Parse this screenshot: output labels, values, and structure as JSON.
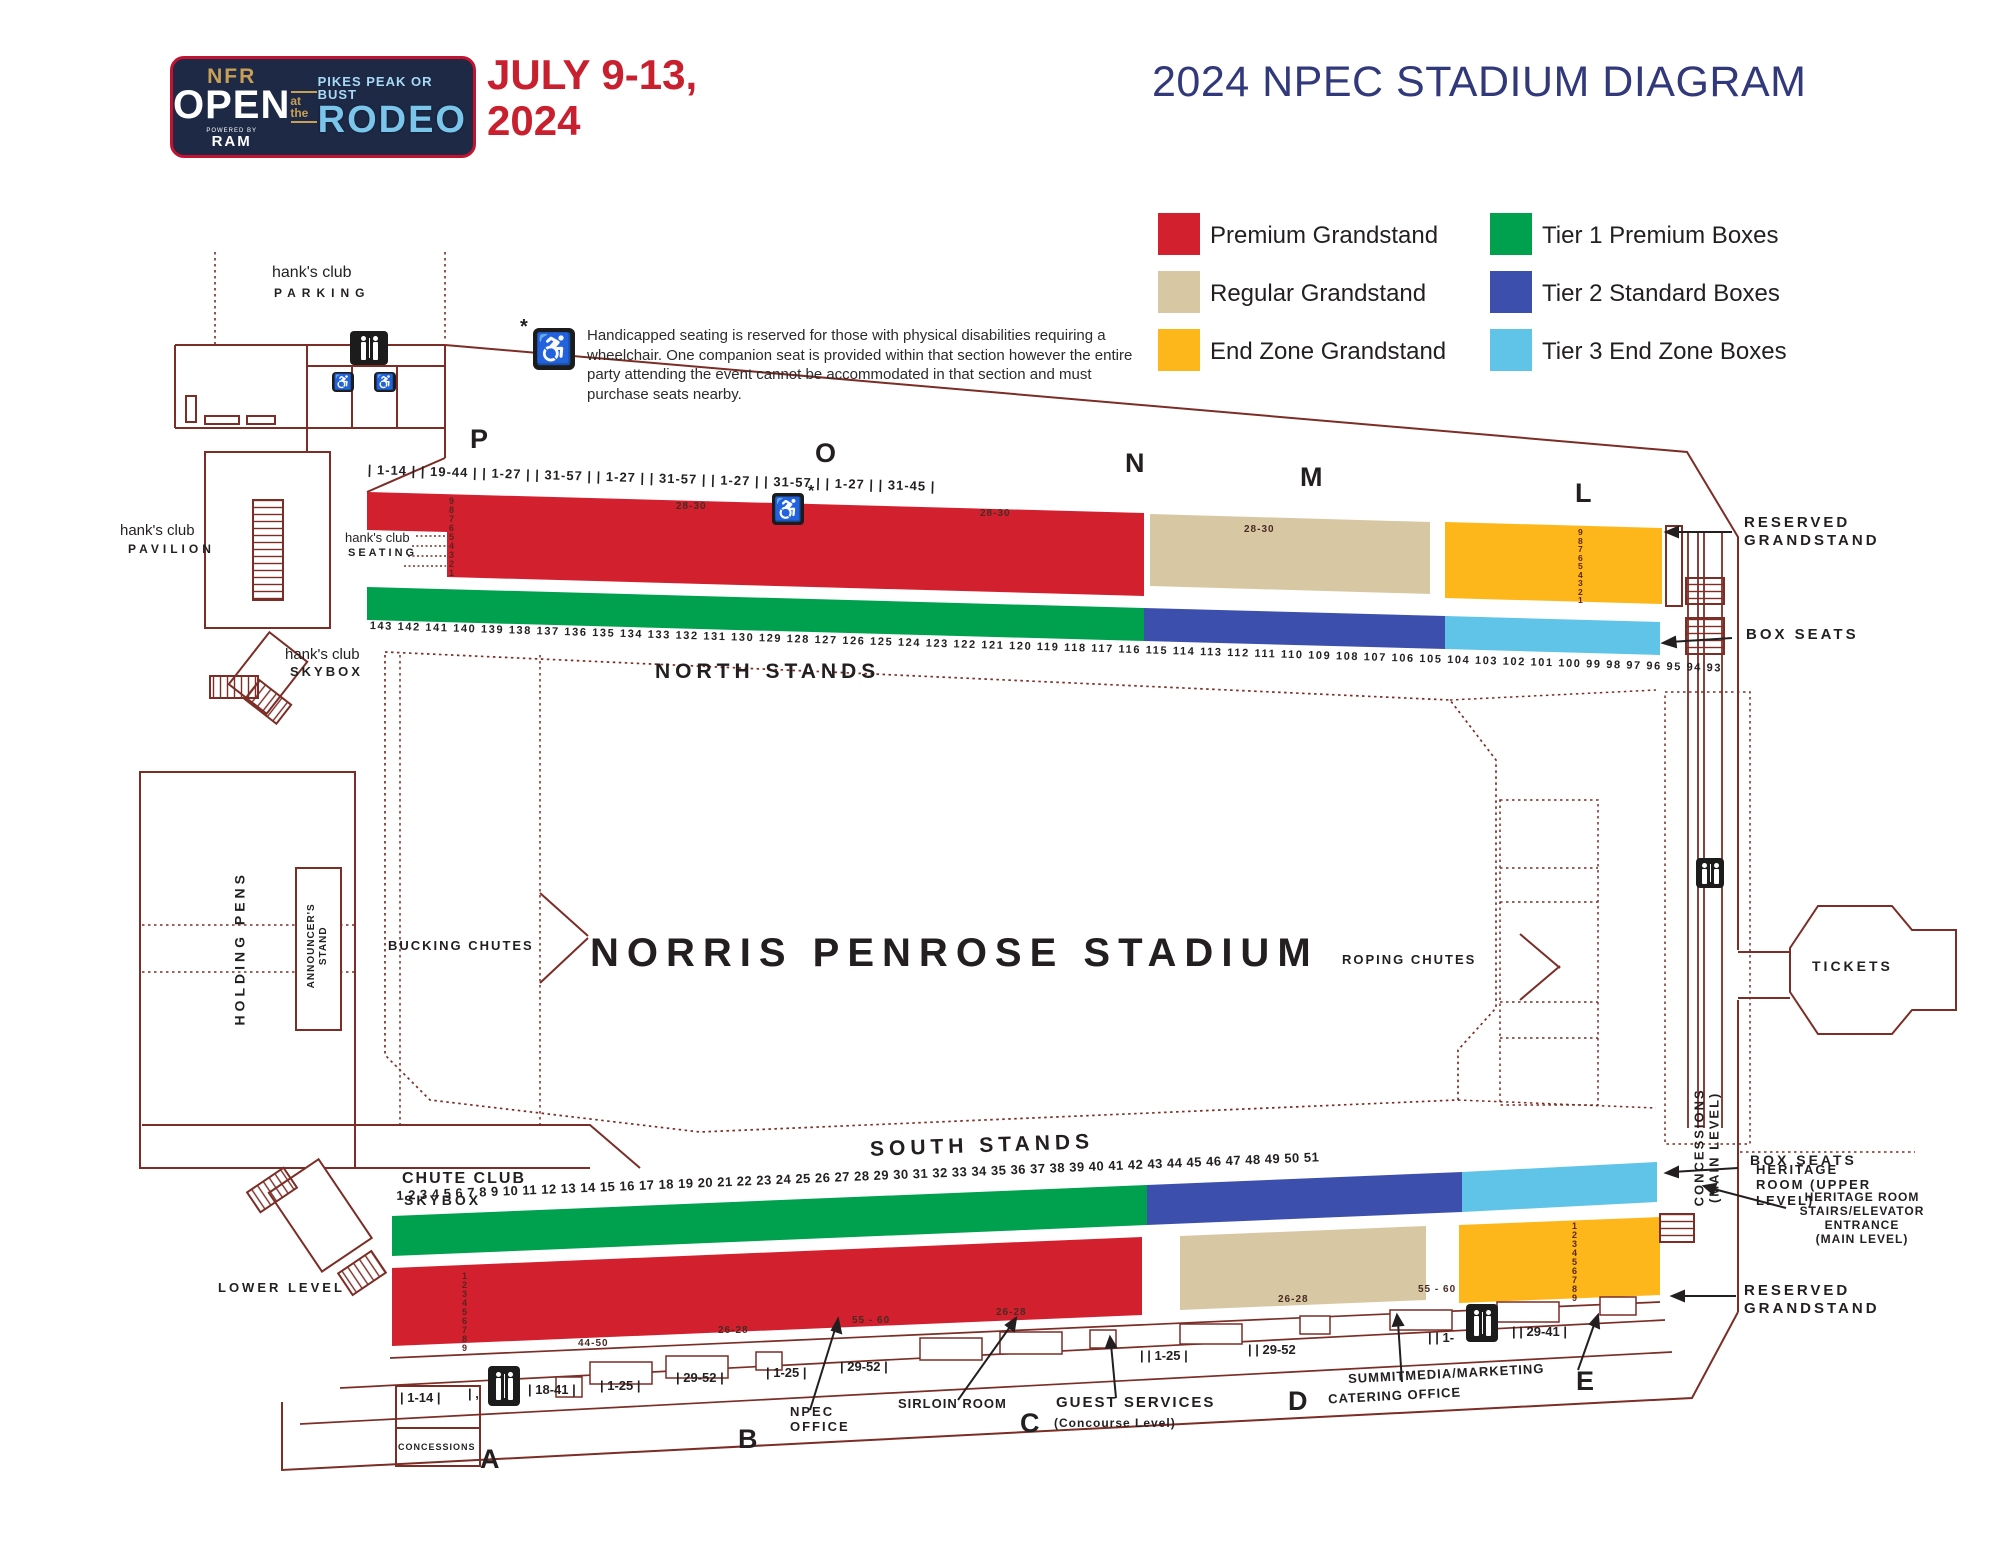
{
  "header": {
    "logo": {
      "nfr": "NFR",
      "open": "OPEN",
      "powered_by": "POWERED BY",
      "ram": "RAM",
      "at_the": "at the",
      "tagline": "PIKES PEAK OR BUST",
      "rodeo": "RODEO"
    },
    "dates": "JULY 9-13,\n2024",
    "title": "2024 NPEC STADIUM DIAGRAM"
  },
  "legend": {
    "items": [
      {
        "label": "Premium Grandstand",
        "color": "#d2202f"
      },
      {
        "label": "Regular Grandstand",
        "color": "#d8c7a3"
      },
      {
        "label": "End Zone Grandstand",
        "color": "#fdb71a"
      },
      {
        "label": "Tier 1 Premium Boxes",
        "color": "#00a14e"
      },
      {
        "label": "Tier 2 Standard Boxes",
        "color": "#3d4fad"
      },
      {
        "label": "Tier 3 End Zone Boxes",
        "color": "#5fc4e8"
      }
    ]
  },
  "note": {
    "asterisk": "*",
    "text": "Handicapped seating is reserved for those with physical disabilities requiring a wheelchair. One companion seat is provided within that section however the entire party attending the event cannot be accommodated in that section and must purchase seats nearby."
  },
  "arena": {
    "name": "NORRIS PENROSE STADIUM",
    "bucking_chutes": "BUCKING CHUTES",
    "roping_chutes": "ROPING CHUTES",
    "holding_pens": "HOLDING PENS",
    "announcer_stand": "ANNOUNCER'S\nSTAND"
  },
  "north": {
    "stands_label": "NORTH STANDS",
    "sections": [
      "P",
      "O",
      "N",
      "M",
      "L"
    ],
    "seat_ranges": "| 1-14 |  | 19-44 |  | 1-27 |  | 31-57 |  | 1-27 |  | 31-57 |  | 1-27 |  | 31-57 |  | 1-27 |  | 31-45 |",
    "box_numbers": "143 142 141 140 139 138 137 136 135 134 133 132 131 130 129 128 127 126 125 124 123 122 121 120 119 118 117 116 115 114 113 112 111 110 109 108 107 106 105 104 103 102 101 100 99 98 97 96 95 94 93",
    "premium_row_numbers": "9\n8\n7\n6\n5\n4\n3\n2\n1",
    "endzone_row_numbers": "9\n8\n7\n6\n5\n4\n3\n2\n1",
    "row_label_1": "28-30",
    "row_label_2": "28-30",
    "row_label_3": "28-30",
    "handicap_star": "*",
    "reserved_grandstand": "RESERVED\nGRANDSTAND",
    "box_seats": "BOX SEATS"
  },
  "south": {
    "stands_label": "SOUTH STANDS",
    "sections": [
      "A",
      "B",
      "C",
      "D",
      "E"
    ],
    "box_numbers": "1 2 3 4 5 6 7 8 9 10 11 12 13 14 15 16 17 18 19 20 21 22 23 24 25 26 27 28 29 30 31 32 33 34 35 36 37 38 39 40 41 42 43 44 45 46 47 48 49 50 51",
    "premium_row_numbers": "1\n2\n3\n4\n5\n6\n7\n8\n9",
    "endzone_row_numbers": "1\n2\n3\n4\n5\n6\n7\n8\n9",
    "concourse_ranges": [
      "| 1-14 |",
      "| ,",
      "| 18-41 |",
      "| 1-25 |",
      "| 29-52 |",
      "| 1-25 |",
      "| 29-52 |",
      "| | 1-25 |",
      "| | 29-52",
      "| | 1-",
      "| | 29-41 |"
    ],
    "aisle_labels": [
      "44-50",
      "26-28",
      "55 - 60",
      "26-28",
      "26-28",
      "55 - 60"
    ],
    "reserved_grandstand": "RESERVED\nGRANDSTAND",
    "box_seats": "BOX SEATS",
    "heritage_stairs": "HERITAGE ROOM\nSTAIRS/ELEVATOR\nENTRANCE\n(MAIN LEVEL)"
  },
  "facilities": {
    "hanks_club": "hank's club",
    "parking": "PARKING",
    "pavilion": "PAVILION",
    "seating": "SEATING",
    "skybox": "SKYBOX",
    "chute_club": "CHUTE CLUB",
    "chute_club_skybox": "SKYBOX",
    "lower_level": "LOWER LEVEL",
    "tickets": "TICKETS",
    "concessions_main": "CONCESSIONS\n(MAIN LEVEL)",
    "heritage_upper": "HERITAGE\nROOM    (UPPER\nLEVEL)",
    "npec_office": "NPEC\nOFFICE",
    "sirloin_room": "SIRLOIN ROOM",
    "guest_services": "GUEST SERVICES",
    "guest_services_sub": "(Concourse Level)",
    "summit_media": "SUMMITMEDIA/MARKETING",
    "catering_office": "CATERING OFFICE",
    "concessions_small": "CONCESSIONS"
  },
  "colors": {
    "outline": "#7b2d26",
    "premium": "#d2202f",
    "regular": "#d8c7a3",
    "endzone": "#fdb71a",
    "tier1": "#00a14e",
    "tier2": "#3d4fad",
    "tier3": "#5fc4e8",
    "title": "#32397b",
    "date_red": "#c8202e",
    "logo_navy": "#1d2945"
  }
}
